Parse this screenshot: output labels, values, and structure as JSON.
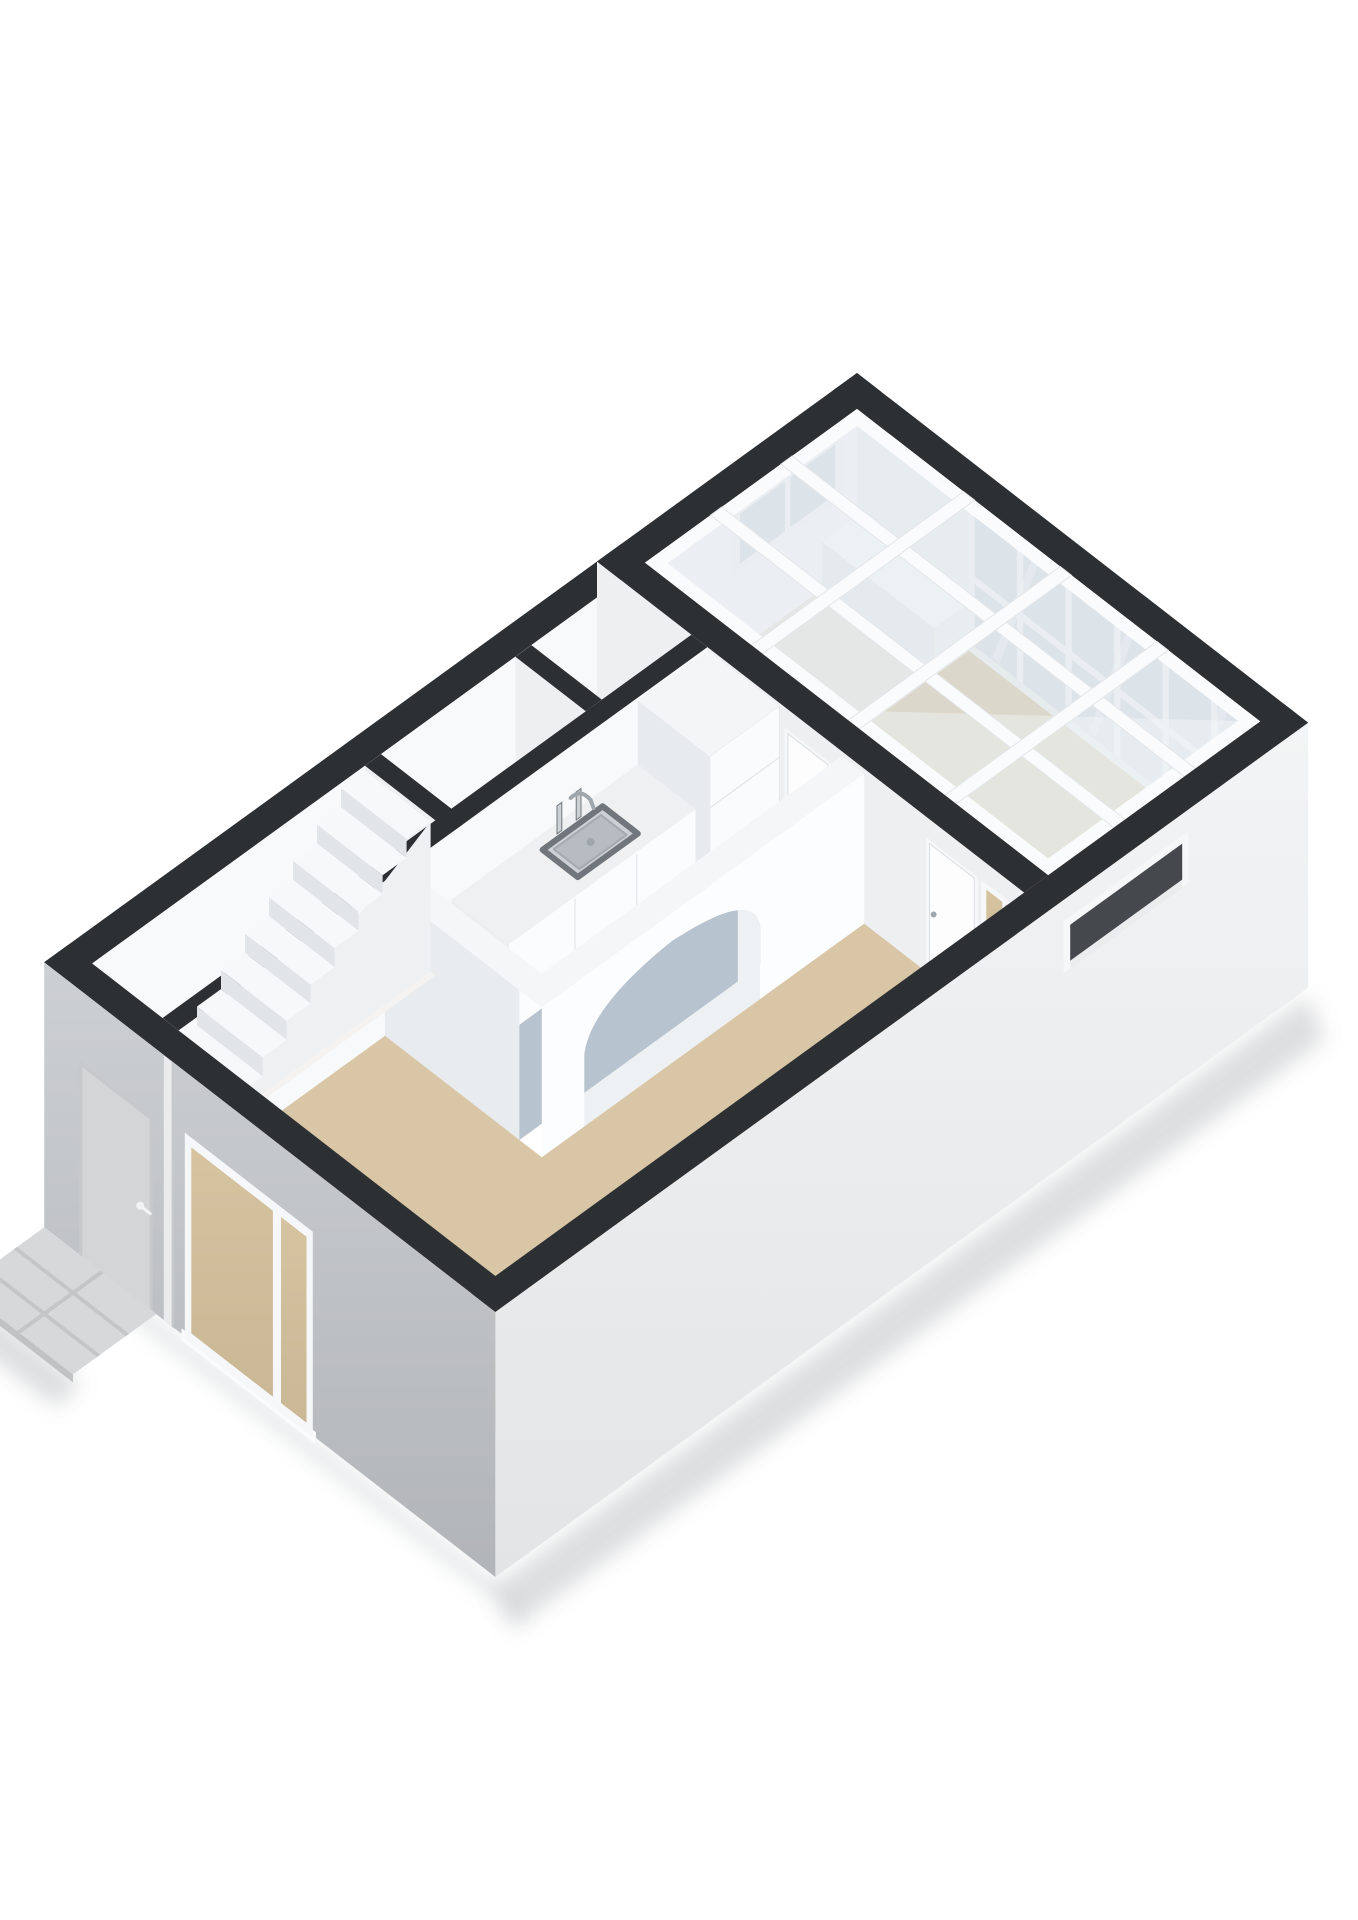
{
  "scene": {
    "type": "3d-floorplan-render",
    "projection": "isometric-cutaway",
    "floor_label": "ground-floor",
    "rooms": [
      {
        "name": "conservatory",
        "floor": "floorTan",
        "features": [
          "glass-roof-grid",
          "glazed-back-wall",
          "high-window",
          "low-bench"
        ]
      },
      {
        "name": "kitchen",
        "floor": "floorBlue",
        "features": [
          "counter",
          "sink",
          "faucet",
          "tall-cabinet",
          "door-to-conservatory"
        ]
      },
      {
        "name": "living-room",
        "floor": "floorTan",
        "features": [
          "arched-opening",
          "door-to-conservatory",
          "interior-window"
        ]
      },
      {
        "name": "entrance-hall",
        "floor": "floorWhite",
        "features": [
          "staircase",
          "front-door"
        ]
      },
      {
        "name": "toilet",
        "floor": "floorWhite",
        "features": [
          "cistern"
        ]
      },
      {
        "name": "closet",
        "floor": "floorWhite",
        "features": []
      }
    ],
    "exterior": [
      "front-facade",
      "right-facade",
      "entrance-stoop",
      "big-front-window",
      "slot-window",
      "drain-pipe"
    ]
  },
  "colors": {
    "bg": "#ffffff",
    "wallTop": "#2d3033",
    "wallFaceA": "#f8f9fa",
    "wallFaceB": "#edeff1",
    "wallFaceB2": "#e9ecee",
    "archWhite": "#fcfdfe",
    "archTop": "#f4f6f7",
    "reveal": "#eef1f3",
    "facadeFrontTop": "#cdd0d3",
    "facadeFrontBottom": "#b2b5b8",
    "facadeRightTop": "#f3f4f5",
    "facadeRightBottom": "#e2e4e6",
    "floorTan": "#d8c6a6",
    "floorPale": "#ece8e0",
    "floorBlue": "#b7c3ce",
    "floorWhite": "#f4f3f1",
    "glassPanel": "#dfe7ec",
    "glassHi": "#f2f6f8",
    "beamWhite": "#fafbfc",
    "glazing": "#d9e0e6",
    "frameWhite": "#f6f7f8",
    "doorLeaf": "#fdfdfd",
    "doorGray": "#d3d5d7",
    "doorFrameGray": "#c6c8ca",
    "glassTan": "#d6c3a0",
    "glassTanDark": "#c9b795",
    "counterTop": "#eef0f1",
    "counterFace": "#fbfcfd",
    "cabinetShine": "#e8ebee",
    "steel": "#9fa6ac",
    "steelDark": "#70767c",
    "steelLight": "#ccd1d5",
    "bowl": "#b6bcc1",
    "treadTop": "#f7f8f9",
    "riser": "#e2e5e8",
    "stringer": "#eef0f2",
    "stoop": "#d6d8da",
    "stoopLine": "#c3c5c7",
    "slotDark": "#45494d",
    "shadow": "#8d9298"
  }
}
